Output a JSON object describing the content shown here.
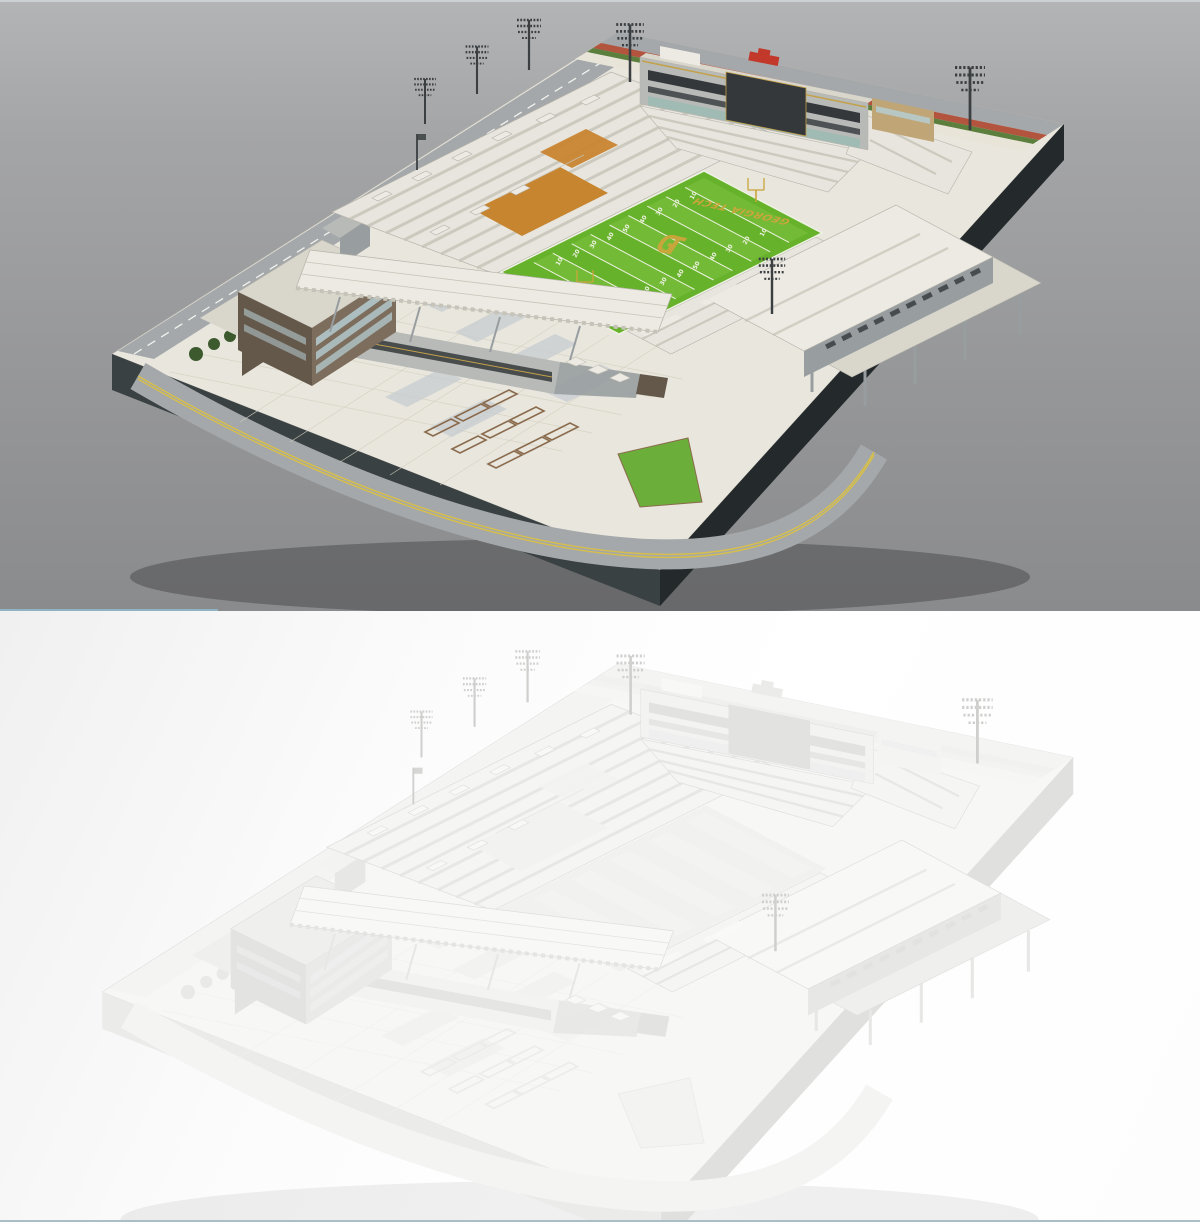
{
  "renders": {
    "textured": {
      "palette": {
        "plinth-top": "#e8e6dd",
        "plinth-side-l": "#3a4143",
        "plinth-side-r": "#24292b",
        "road": "#a4a8aa",
        "road-mark": "#f2f2ee",
        "road-mark-y": "#d8bf49",
        "street-red": "#b2543e",
        "street-green": "#5d7f3d",
        "plaza": "#e8e5d8",
        "plaza-line": "#d5d1c0",
        "panel-gray": "#c6cbd1",
        "planter": "#8a6b4d",
        "lawn": "#6cae3a",
        "tree": "#3d5a2e",
        "roof": "#eceae2",
        "roof-shade": "#d9d6cc",
        "seat-base": "#e7e5dd",
        "seat-line": "#c6c3b8",
        "orange": "#c8852f",
        "brick-wall": "#7d6d5c",
        "brick-dark": "#64584a",
        "window": "#b5ccd1",
        "glass-teal": "#8fbab2",
        "pressbox-dark": "#34383b",
        "pressbox-base": "#b8bab7",
        "sign-gold": "#c3a149",
        "red-obj": "#c2392b",
        "tan": "#c0a677",
        "field": "#67b22b",
        "field-stripe": "#73bb37",
        "field-line": "#eef2e2",
        "field-gold": "#c9a63b",
        "structure": "#989da0",
        "mast": "#3b3f41",
        "edge": "#b5b3aa",
        "ground-shadow": "rgba(25,28,30,0.30)"
      }
    },
    "clay": {
      "palette": {
        "plinth-top": "#f7f7f6",
        "plinth-side-l": "#ebebea",
        "plinth-side-r": "#e0e0df",
        "road": "#f4f4f3",
        "road-mark": "transparent",
        "road-mark-y": "transparent",
        "street-red": "#f1f1f0",
        "street-green": "#f3f3f2",
        "plaza": "#f6f6f5",
        "plaza-line": "#f0f0ef",
        "panel-gray": "#f1f1f0",
        "planter": "#ececeb",
        "lawn": "#f3f3f2",
        "tree": "#e9e9e8",
        "roof": "#f8f8f7",
        "roof-shade": "#efefee",
        "seat-base": "#f5f5f4",
        "seat-line": "#e4e4e3",
        "orange": "#f2f2f1",
        "brick-wall": "#eaeae9",
        "brick-dark": "#e3e3e2",
        "window": "#efefee",
        "glass-teal": "#ededec",
        "pressbox-dark": "#e2e2e1",
        "pressbox-base": "#f3f3f2",
        "sign-gold": "transparent",
        "red-obj": "#ebebea",
        "tan": "#f4f4f3",
        "field": "#f1f1f0",
        "field-stripe": "#f3f3f2",
        "field-line": "transparent",
        "field-gold": "transparent",
        "structure": "#e7e7e6",
        "mast": "#cfcfce",
        "edge": "#dededd",
        "ground-shadow": "rgba(0,0,0,0.06)"
      }
    }
  },
  "field": {
    "endzone_text_north": "GEORGIA TECH",
    "endzone_text_south": "GEORGIA TECH",
    "center_logo": "GT",
    "yard_numbers": [
      "10",
      "20",
      "30",
      "40",
      "50",
      "40",
      "30",
      "20",
      "10"
    ]
  }
}
